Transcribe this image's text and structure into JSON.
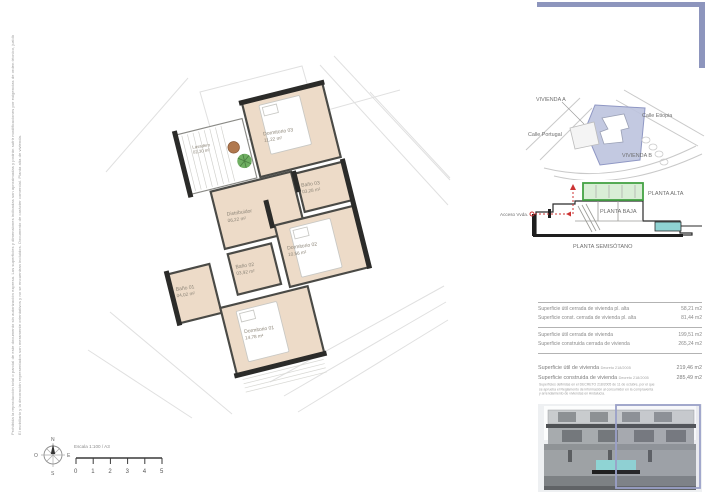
{
  "floor_plan": {
    "rooms": [
      {
        "name": "Lavadero",
        "area": "02,30 m²"
      },
      {
        "name": "Dormitorio 03",
        "area": "11,22 m²"
      },
      {
        "name": "Baño 03",
        "area": "03,28 m²"
      },
      {
        "name": "Distribuidor",
        "area": "06,22 m²"
      },
      {
        "name": "Dormitorio 02",
        "area": "10,56 m²"
      },
      {
        "name": "Baño 02",
        "area": "03,92 m²"
      },
      {
        "name": "Baño 01",
        "area": "04,02 m²"
      },
      {
        "name": "Dormitorio 01",
        "area": "14,78 m²"
      }
    ]
  },
  "location_map": {
    "vivienda_a": "VIVIENDA A",
    "calle_etiopia": "Calle Etiopia",
    "calle_portugal": "Calle Portugal",
    "vivienda_b": "VIVIENDA B",
    "plot_color": "#bdc3de"
  },
  "section": {
    "planta_alta": "PLANTA ALTA",
    "planta_baja": "PLANTA BAJA",
    "planta_semisotano": "PLANTA SEMISÓTANO",
    "acceso": "Acceso Vvda.",
    "highlight_color": "#44a244",
    "access_color": "#cc3333",
    "pool_color": "#8fd2d2"
  },
  "surfaces_table": {
    "rows": [
      {
        "label": "Superficie útil cerrada de vivienda pl. alta",
        "value": "58,21 m2"
      },
      {
        "label": "Superficie const. cerrada de vivienda pl. alta",
        "value": "81,44 m2"
      },
      {
        "label": "Superficie útil cerrada de vivienda",
        "value": "199,51 m2"
      },
      {
        "label": "Superficie construida cerrada de vivienda",
        "value": "265,24 m2"
      }
    ]
  },
  "totals_table": {
    "rows": [
      {
        "label": "Superficie útil de vivienda",
        "norm": "Decreto 218/2005",
        "value": "219,46 m2"
      },
      {
        "label": "Superficie construida de vivienda",
        "norm": "Decreto 218/2005",
        "value": "285,49 m2"
      }
    ],
    "note": "Superficies definidas en el DECRETO 218/2005 de 11 de octubre, por el que se aprueba el Reglamento de información al consumidor en la compraventa y arrendamiento de viviendas en Andalucía."
  },
  "scale_bar": {
    "label": "Escala 1:100 / A3",
    "ticks": [
      "0",
      "1",
      "2",
      "3",
      "4",
      "5"
    ]
  },
  "compass": {
    "north": "N",
    "south": "S",
    "east": "E",
    "west": "O"
  },
  "left_margin": {
    "line1": "Prohibida la reproducción total o parcial de este documento sin autorización expresa. Las superficies y dimensiones indicadas son aproximadas y podrán sufrir modificaciones por exigencias de orden técnico, jurídico o administrativo durante el desarrollo de la obra.",
    "line2": "El mobiliario y la decoración representados son meramente orientativos y no se encuentran incluidos. Documento de carácter comercial. Planta alta de vivienda."
  },
  "accent_colors": {
    "frame": "#8d95bd",
    "wall": "#2b2b29",
    "floor": "#eddbc8"
  }
}
